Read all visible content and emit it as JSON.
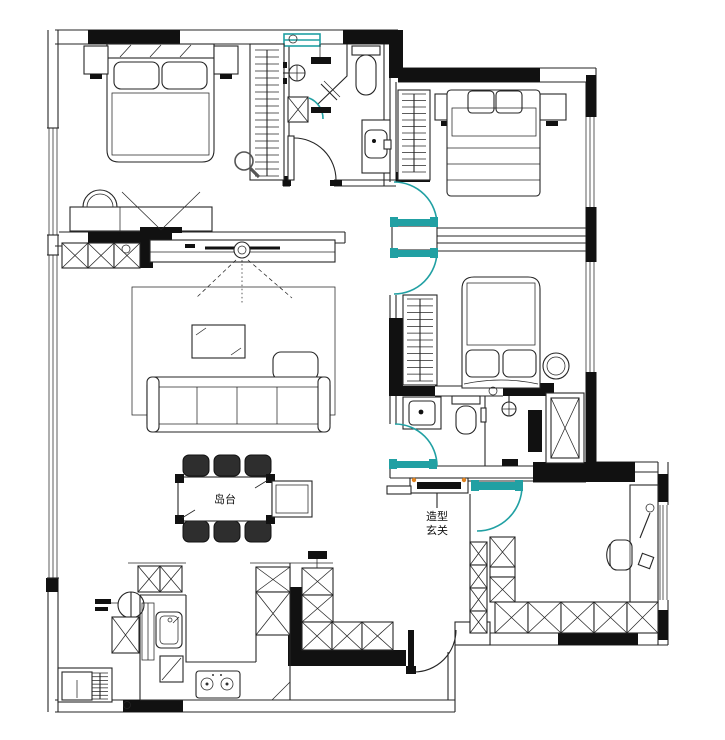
{
  "labels": {
    "island_table": "岛台",
    "entry_feature_line1": "造型",
    "entry_feature_line2": "玄关"
  },
  "colors": {
    "wall_fill": "#111111",
    "line": "#262626",
    "door_accent": "#21a0a3",
    "marker_accent": "#e0821e",
    "background": "#ffffff",
    "muted": "#8c8c8c"
  }
}
